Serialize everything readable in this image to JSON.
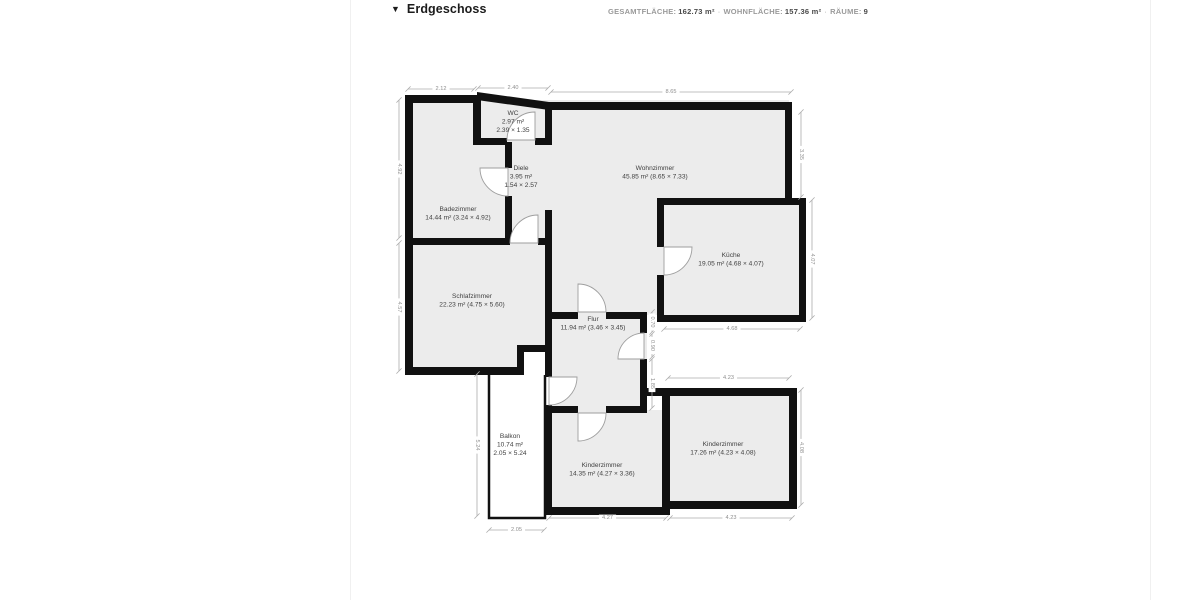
{
  "header": {
    "collapse_icon": "▼",
    "title": "Erdgeschoss",
    "stats": [
      {
        "label": "GESAMTFLÄCHE:",
        "value": "162.73 m²"
      },
      {
        "label": "WOHNFLÄCHE:",
        "value": "157.36 m²"
      },
      {
        "label": "RÄUME:",
        "value": "9"
      }
    ],
    "separator": "·"
  },
  "plan": {
    "rooms": [
      {
        "id": "wc",
        "lines": [
          "WC",
          "2.97 m²",
          "2.39 × 1.35"
        ],
        "x": 513,
        "y": 115
      },
      {
        "id": "diele",
        "lines": [
          "Diele",
          "3.95 m²",
          "1.54 × 2.57"
        ],
        "x": 521,
        "y": 170
      },
      {
        "id": "badezimmer",
        "lines": [
          "Badezimmer",
          "14.44 m² (3.24 × 4.92)"
        ],
        "x": 458,
        "y": 211
      },
      {
        "id": "wohnzimmer",
        "lines": [
          "Wohnzimmer",
          "45.85 m² (8.65 × 7.33)"
        ],
        "x": 655,
        "y": 170
      },
      {
        "id": "kueche",
        "lines": [
          "Küche",
          "19.05 m² (4.68 × 4.07)"
        ],
        "x": 731,
        "y": 257
      },
      {
        "id": "schlafzimmer",
        "lines": [
          "Schlafzimmer",
          "22.23 m² (4.75 × 5.60)"
        ],
        "x": 472,
        "y": 298
      },
      {
        "id": "flur",
        "lines": [
          "Flur",
          "11.94 m² (3.46 × 3.45)"
        ],
        "x": 593,
        "y": 321
      },
      {
        "id": "balkon",
        "lines": [
          "Balkon",
          "10.74 m²",
          "2.05 × 5.24"
        ],
        "x": 510,
        "y": 438
      },
      {
        "id": "kinderzimmer-1",
        "lines": [
          "Kinderzimmer",
          "14.35 m² (4.27 × 3.36)"
        ],
        "x": 602,
        "y": 467
      },
      {
        "id": "kinderzimmer-2",
        "lines": [
          "Kinderzimmer",
          "17.26 m² (4.23 × 4.08)"
        ],
        "x": 723,
        "y": 446
      }
    ],
    "dimensions": [
      {
        "value": "2.12",
        "orient": "h",
        "x1": 408,
        "x2": 474,
        "y": 89
      },
      {
        "value": "2.40",
        "orient": "h",
        "x1": 478,
        "x2": 548,
        "y": 88
      },
      {
        "value": "8.65",
        "orient": "h",
        "x1": 551,
        "x2": 791,
        "y": 92
      },
      {
        "value": "4.92",
        "orient": "v",
        "x": 399,
        "y1": 100,
        "y2": 238
      },
      {
        "value": "4.57",
        "orient": "v",
        "x": 399,
        "y1": 243,
        "y2": 371
      },
      {
        "value": "5.24",
        "orient": "v",
        "x": 477,
        "y1": 374,
        "y2": 516
      },
      {
        "value": "3.35",
        "orient": "v",
        "x": 801,
        "y1": 112,
        "y2": 197
      },
      {
        "value": "4.07",
        "orient": "v",
        "x": 812,
        "y1": 200,
        "y2": 318
      },
      {
        "value": "4.08",
        "orient": "v",
        "x": 801,
        "y1": 390,
        "y2": 505
      },
      {
        "value": "4.68",
        "orient": "h",
        "x1": 664,
        "x2": 800,
        "y": 329
      },
      {
        "value": "4.23",
        "orient": "h",
        "x1": 668,
        "x2": 789,
        "y": 378
      },
      {
        "value": "4.27",
        "orient": "h",
        "x1": 549,
        "x2": 666,
        "y": 518
      },
      {
        "value": "4.23",
        "orient": "h",
        "x1": 670,
        "x2": 792,
        "y": 518
      },
      {
        "value": "2.05",
        "orient": "h",
        "x1": 489,
        "x2": 544,
        "y": 530
      },
      {
        "value": "0.70",
        "orient": "v",
        "x": 652,
        "y1": 312,
        "y2": 332
      },
      {
        "value": "0.90",
        "orient": "v",
        "x": 652,
        "y1": 334,
        "y2": 357
      },
      {
        "value": "1.85",
        "orient": "v",
        "x": 652,
        "y1": 359,
        "y2": 408
      }
    ]
  },
  "colors": {
    "wall": "#111111",
    "room_fill": "#ececec",
    "dimension_line": "#ababab",
    "dimension_text": "#8f8f8f",
    "room_text": "#3f3f3f",
    "door_stroke": "#9e9e9e"
  }
}
